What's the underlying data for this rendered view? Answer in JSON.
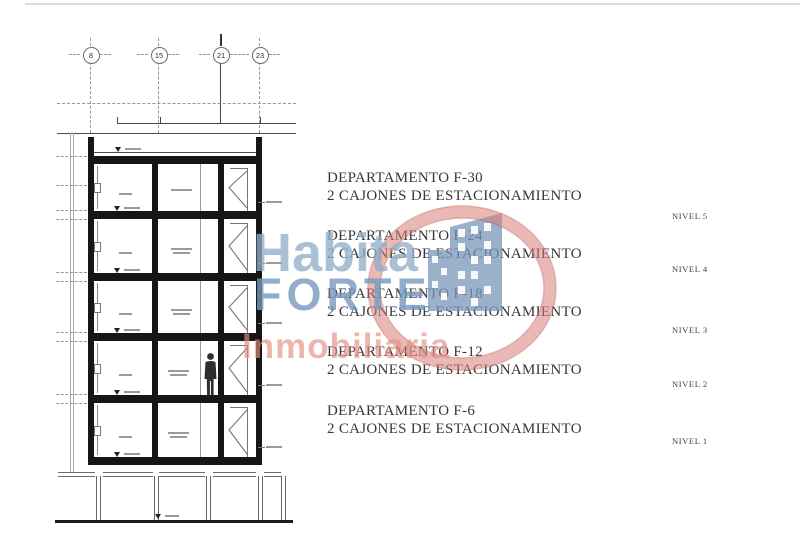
{
  "page": {
    "background": "#ffffff",
    "type": "architectural-section-drawing"
  },
  "grid": {
    "bubbles": [
      "8",
      "15",
      "21",
      "23"
    ]
  },
  "units": [
    {
      "department": "DEPARTAMENTO F-30",
      "parking": "2 CAJONES DE ESTACIONAMIENTO",
      "level": "NIVEL 5"
    },
    {
      "department": "DEPARTAMENTO F-24",
      "parking": "2 CAJONES DE ESTACIONAMIENTO",
      "level": "NIVEL 4"
    },
    {
      "department": "DEPARTAMENTO F-18",
      "parking": "2 CAJONES DE ESTACIONAMIENTO",
      "level": "NIVEL 3"
    },
    {
      "department": "DEPARTAMENTO F-12",
      "parking": "2 CAJONES DE ESTACIONAMIENTO",
      "level": "NIVEL 2"
    },
    {
      "department": "DEPARTAMENTO F-6",
      "parking": "2 CAJONES DE ESTACIONAMIENTO",
      "level": "NIVEL 1"
    }
  ],
  "watermark": {
    "word1": "Habita",
    "word2": "FORTE",
    "word3": "Inmobiliaria",
    "colors": {
      "word1": "#92aec9",
      "word2": "#7699be",
      "word3": "#e38f84",
      "ring": "#d87d78",
      "logo_building": "#7a96b8"
    }
  }
}
